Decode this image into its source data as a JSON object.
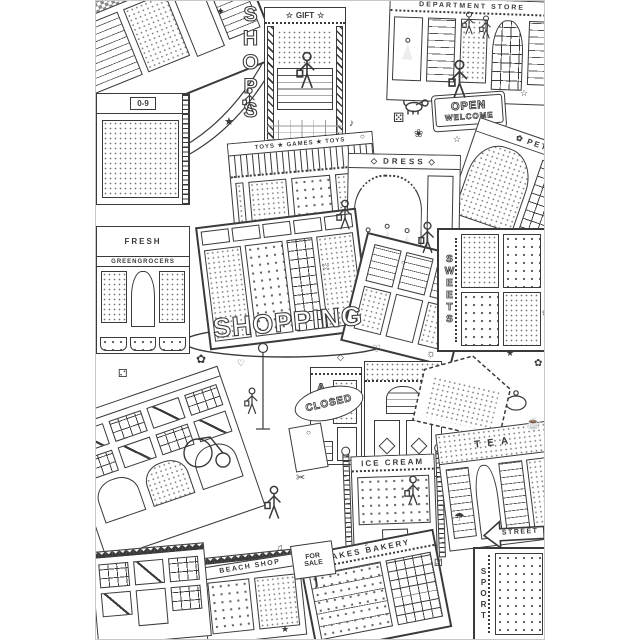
{
  "poster": {
    "title": "SHOPPING",
    "side_title": "SHOPS",
    "signs": {
      "gift": "GIFT",
      "department_store": "DEPARTMENT STORE",
      "open": "OPEN",
      "welcome": "WELCOME",
      "pet_shop": "PET SHOP",
      "toys_games": "TOYS ★ GAMES ★ TOYS",
      "dress": "DRESS",
      "numbers": "0-9",
      "fresh": "FRESH",
      "greengrocers": "GREENGROCERS",
      "sweets": "SWEETS",
      "closed": "CLOSED",
      "art": "ART",
      "ice_cream": "ICE CREAM",
      "tea": "TEA",
      "for_sale_line1": "FOR",
      "for_sale_line2": "SALE",
      "beach_shop": "BEACH SHOP",
      "cakes_bakery": "CAKES BAKERY",
      "street": "STREET",
      "sport": "SPORT"
    },
    "colors": {
      "ink": "#3a3a3a",
      "light_ink": "#8a8a8a",
      "paper": "#ffffff",
      "frame": "#c9c9c9"
    }
  },
  "doodles": {
    "star": "★",
    "star-outline": "☆",
    "flower": "✿",
    "flower-outline": "❀",
    "music-note": "♪",
    "music-notes": "♫",
    "dice-five": "⚄",
    "dice-two": "⚁",
    "circle": "○",
    "diamond": "◇",
    "heart": "♡",
    "sun": "☼",
    "sparkle": "✦",
    "umbrella": "☂",
    "teacup": "☕",
    "scissors": "✂"
  }
}
